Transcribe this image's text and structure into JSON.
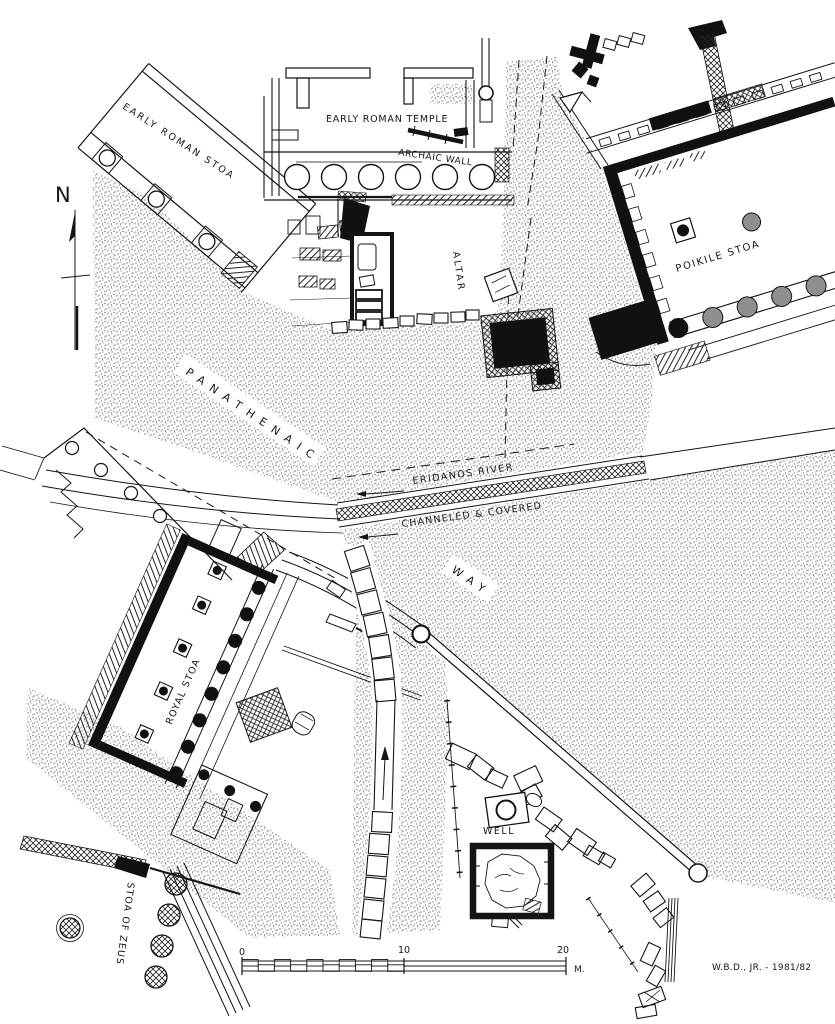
{
  "map": {
    "north_label": "N",
    "labels": {
      "early_roman_stoa": "EARLY ROMAN STOA",
      "early_roman_temple": "EARLY ROMAN TEMPLE",
      "archaic_wall": "ARCHAIC WALL",
      "altar": "ALTAR",
      "poikile_stoa": "POIKILE STOA",
      "panathenaic": "PANATHENAIC",
      "way": "WAY",
      "eridanos_river": "ERIDANOS RIVER",
      "channeled_covered": "CHANNELED & COVERED",
      "royal_stoa": "ROYAL STOA",
      "stoa_of_zeus": "STOA OF ZEUS",
      "well": "WELL"
    },
    "scale_bar": {
      "tick_start": "0",
      "tick_mid": "10",
      "tick_end": "20",
      "unit": "M."
    },
    "credit": "W.B.D., JR. - 1981/82",
    "colors": {
      "ink": "#151515",
      "paper": "#ffffff",
      "column_gray": "#8f8f8f",
      "stipple": "#404040"
    }
  }
}
